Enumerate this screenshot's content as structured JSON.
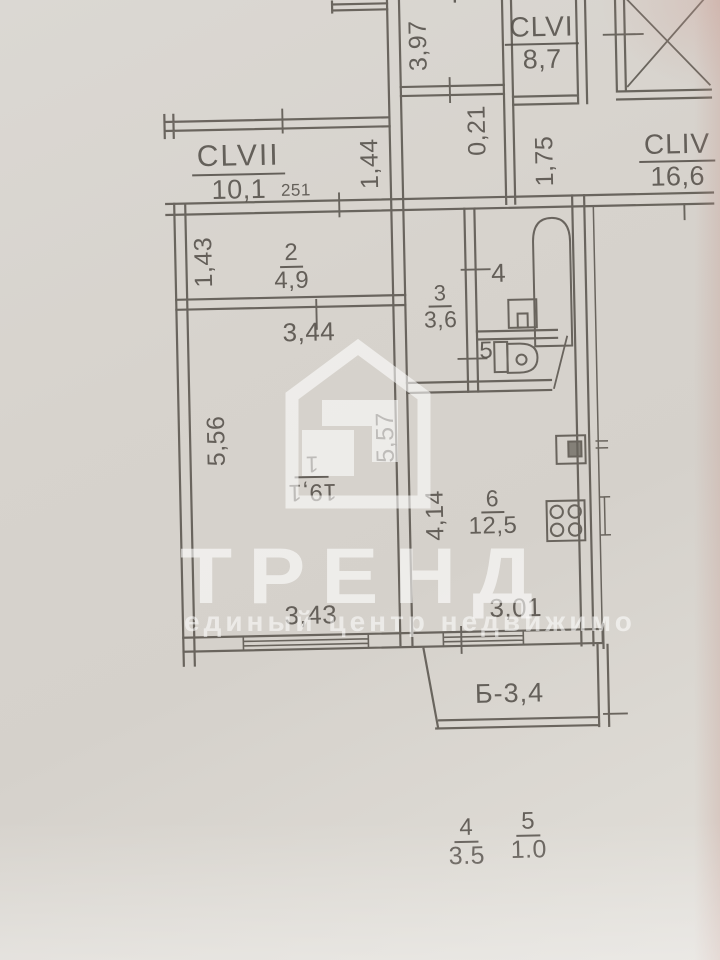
{
  "watermark": {
    "brand": "ТРЕНД",
    "tagline": "единый центр недвижимо"
  },
  "common_areas": {
    "clvii": {
      "name": "CLVII",
      "area": "10,1",
      "note": "251"
    },
    "clvi": {
      "name": "CLVI",
      "area": "8,7"
    },
    "cliv": {
      "name": "CLIV",
      "area": "16,6"
    }
  },
  "rooms": {
    "r1": {
      "num": "1",
      "area": "19,1"
    },
    "r2": {
      "num": "2",
      "area": "4,9"
    },
    "r3": {
      "num": "3",
      "area": "3,6"
    },
    "r4": {
      "num": "4"
    },
    "r5": {
      "num": "5"
    },
    "r6": {
      "num": "6",
      "area": "12,5"
    },
    "balcony": {
      "label": "Б-3,4"
    }
  },
  "dimensions": {
    "top_vert": "3,97",
    "offset": "0,21",
    "corr_height": "1,75",
    "hall_height": "1,44",
    "r2_height": "1,43",
    "r1_width_top": "3,44",
    "r1_height_left": "5,56",
    "r1_height_right": "5,57",
    "kitchen_height": "4,14",
    "r1_width_bottom": "3,43",
    "kitchen_width": "3,01"
  },
  "legend": {
    "items": [
      {
        "num": "4",
        "value": "3.5"
      },
      {
        "num": "5",
        "value": "1.0"
      }
    ]
  },
  "edge_label": "4"
}
